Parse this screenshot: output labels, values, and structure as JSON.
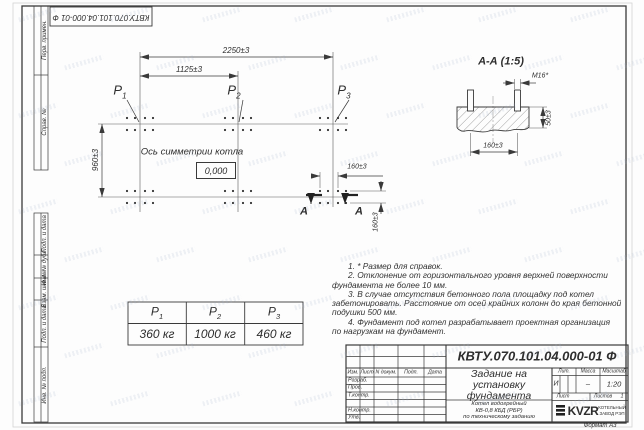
{
  "doc_number": "КВТУ.070.101.04.000-01 Ф",
  "sheet": {
    "format_label": "Формат А3"
  },
  "strip": {
    "labels": [
      "Перв. примен.",
      "Справ. №",
      "Подп. и дата",
      "Инв. № дубл.",
      "Взам. инв. №",
      "Подп. и дата",
      "Инв. № подл."
    ]
  },
  "plan": {
    "axis_label": "Ось симметрии котла",
    "zero_mark": "0,000",
    "p_labels": [
      {
        "base": "Р",
        "sub": "1"
      },
      {
        "base": "Р",
        "sub": "2"
      },
      {
        "base": "Р",
        "sub": "3"
      }
    ],
    "dims": {
      "d2250": "2250±3",
      "d1125": "1125±3",
      "d960": "960±3",
      "d160h": "160±3",
      "d160v": "160±3"
    },
    "section_letter_left": "А",
    "section_letter_right": "А"
  },
  "section": {
    "title": "А-А (1:5)",
    "dims": {
      "bolt": "М16*",
      "d50": "50±3",
      "d160": "160±3"
    }
  },
  "loads_table": {
    "headers": [
      {
        "base": "Р",
        "sub": "1"
      },
      {
        "base": "Р",
        "sub": "2"
      },
      {
        "base": "Р",
        "sub": "3"
      }
    ],
    "values": [
      "360 кг",
      "1000 кг",
      "460 кг"
    ]
  },
  "notes_lines": [
    "1. * Размер для справок.",
    "2. Отклонение от горизонтального уровня верхней поверхности",
    "фундамента не более 10 мм.",
    "3. В случае отсутствия бетонного пола площадку под котел",
    "забетонировать. Расстояние от осей крайних колонн до края бетонной",
    "подушки 500 мм.",
    "4. Фундамент под котел разрабатывает проектная организация",
    "по нагрузкам на фундамент."
  ],
  "stamp": {
    "title_lines": [
      "Задание на",
      "установку",
      "фундамента"
    ],
    "product_lines": [
      "Котел водогрейный",
      "КВ-0,8 КБД (РБР)",
      "по техническому заданию"
    ],
    "cols": {
      "izm": "Изм.",
      "list": "Лист",
      "ndok": "N докум.",
      "podp": "Подп.",
      "data": "Дата"
    },
    "roles": [
      "Разраб.",
      "Пров.",
      "Т.контр.",
      "Н.контр.",
      "Утв."
    ],
    "lit_label": "Лит.",
    "massa_label": "Масса",
    "masshtab_label": "Масштаб",
    "lit": "И",
    "massa": "–",
    "masshtab": "1:20",
    "list_label": "Лист",
    "listov_label": "Листов",
    "listov_value": "1",
    "logo_text": "KVZR",
    "logo_sub1": "КОТЕЛЬНЫЙ",
    "logo_sub2": "ЗАВОД РЭП"
  },
  "colors": {
    "ink": "#3a3a3a",
    "paper": "#fdfdfd",
    "watermark": "#b9c4d6"
  }
}
